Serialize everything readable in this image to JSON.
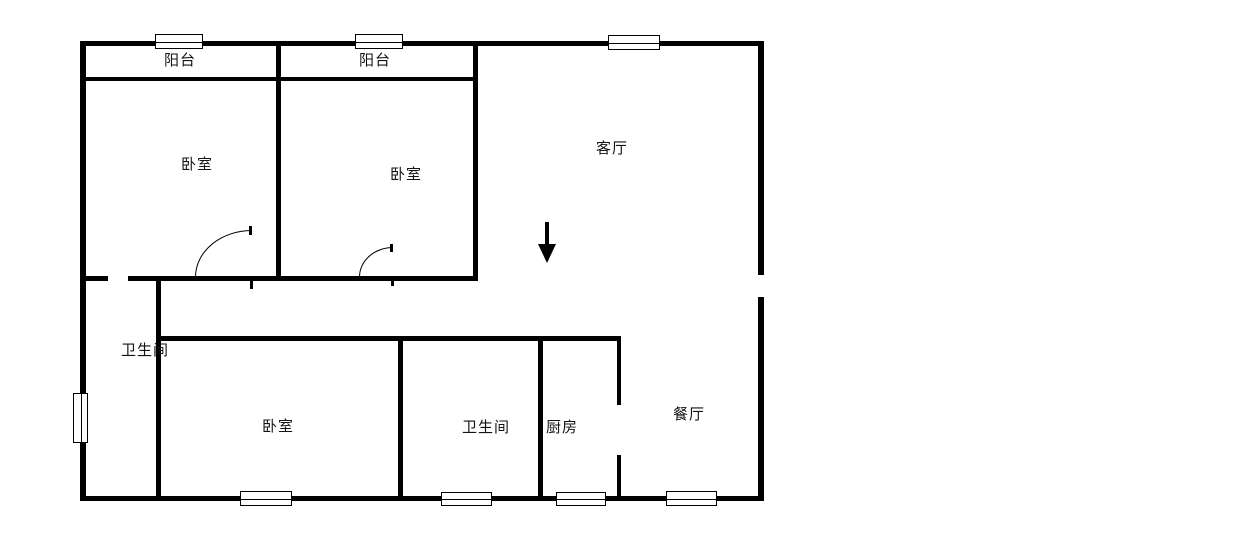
{
  "colors": {
    "wall": "#000000",
    "background": "#ffffff",
    "text": "#141414"
  },
  "rooms": {
    "balcony1": {
      "label": "阳台"
    },
    "balcony2": {
      "label": "阳台"
    },
    "bedroom1": {
      "label": "卧室"
    },
    "bedroom2": {
      "label": "卧室"
    },
    "living": {
      "label": "客厅"
    },
    "bathroom1": {
      "label": "卫生间"
    },
    "bedroom3": {
      "label": "卧室"
    },
    "bathroom2": {
      "label": "卫生间"
    },
    "kitchen": {
      "label": "厨房"
    },
    "dining": {
      "label": "餐厅"
    }
  },
  "symbols": {
    "entrance_arrow": "down-arrow",
    "window_count": 8,
    "door_arc_count": 2
  }
}
